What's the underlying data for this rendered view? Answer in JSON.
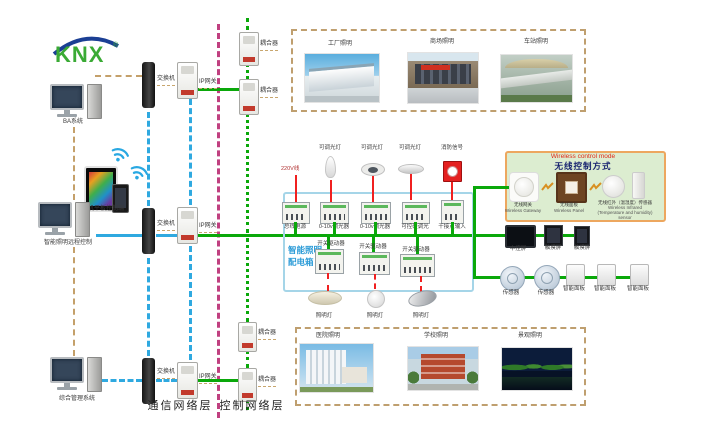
{
  "logo": {
    "text": "KNX",
    "reg": "®"
  },
  "left": {
    "ba": "BA系统",
    "mobile": "手机平板控制端",
    "remote": "智能照明远程控制",
    "mgmt": "综合管理系统"
  },
  "net": {
    "switch": "交换机",
    "gateway": "IP网关",
    "coupler": "耦合器"
  },
  "layers": {
    "comm": "通信网络层",
    "ctrl": "控制网络层"
  },
  "top_box": {
    "labels": [
      "工厂照明",
      "商场照明",
      "车站照明"
    ]
  },
  "bottom_box": {
    "labels": [
      "医院照明",
      "学校照明",
      "景观照明"
    ]
  },
  "cabinet": {
    "title1": "智能照明",
    "title2": "配电箱",
    "power": "220V线",
    "lamps_top": [
      "可调光灯",
      "可调光灯",
      "可调光灯",
      "消防信号"
    ],
    "row1": [
      "总线电源",
      "0-10v调光器",
      "0-10v调光器",
      "可控硅调光",
      "干接点输入"
    ],
    "row2": [
      "开关驱动器",
      "开关驱动器",
      "开关驱动器"
    ],
    "lamps_bottom": [
      "照明灯",
      "照明灯",
      "照明灯"
    ]
  },
  "wireless": {
    "title_en": "Wireless control mode",
    "title_cn": "无线控制方式",
    "devices": [
      {
        "cn": "无线网关",
        "en": "Wireless Gateway"
      },
      {
        "cn": "无线面板",
        "en": "Wireless Panel"
      },
      {
        "cn": "无线红外（温湿度）传感器",
        "en": "Wireless Infrared (Temperature and humidity) sensor"
      }
    ]
  },
  "right": {
    "row1": [
      "中控屏",
      "触摸屏",
      "触摸屏"
    ],
    "row2": [
      "传感器",
      "传感器",
      "智能面板",
      "智能面板",
      "智能面板"
    ]
  },
  "colors": {
    "bus_green": "#0aa80a",
    "ethernet_blue": "#2fa9e0",
    "backbone_magenta": "#c04080",
    "field_tan": "#c4a06a",
    "power_red": "#f02020",
    "knx_green": "#3aaa35",
    "knx_blue": "#1b3f94"
  }
}
